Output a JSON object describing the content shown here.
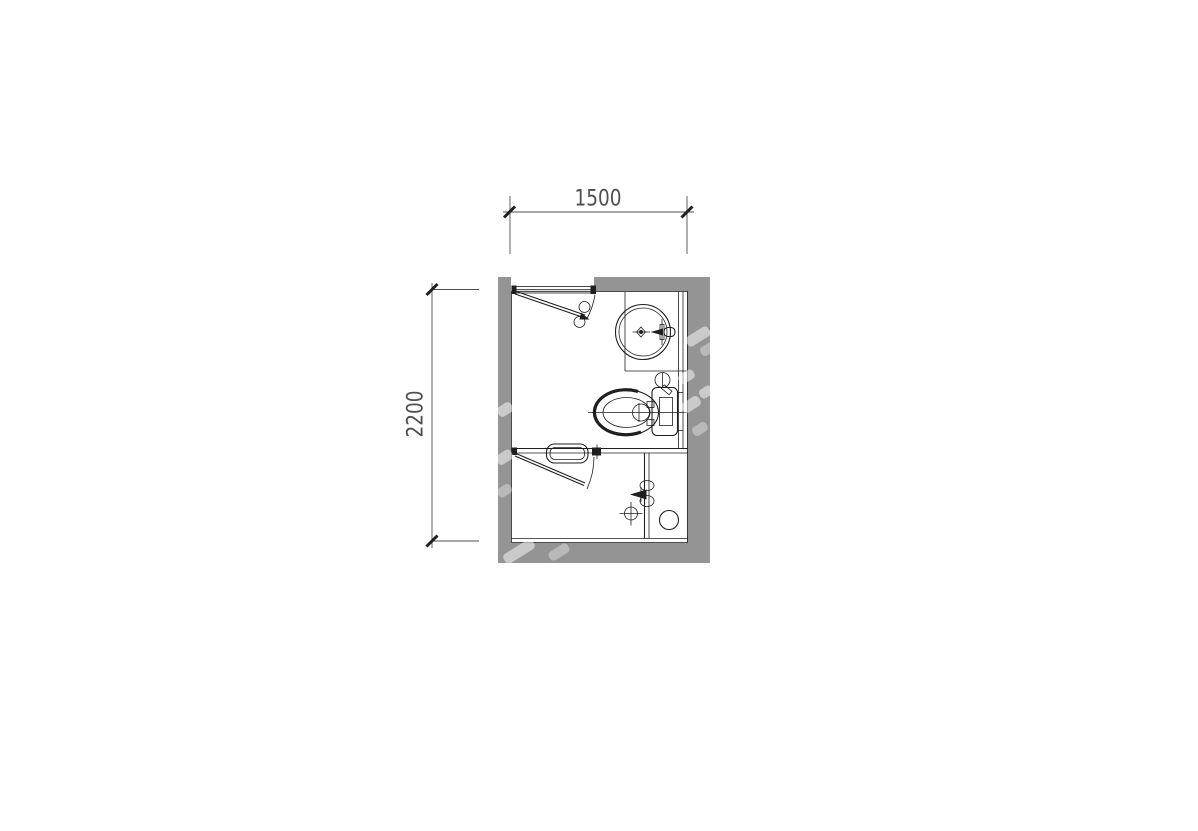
{
  "plan": {
    "description": "bathroom-floor-plan"
  },
  "colors": {
    "background": "#ffffff",
    "wall": "#949494",
    "line": "#1f1f1f",
    "dim": "#4f4f4f",
    "watermark": "#e2e2e2"
  },
  "dimensions": {
    "top": {
      "label": "1500"
    },
    "left": {
      "label": "2200"
    }
  },
  "icons": [
    "entry-door-swing-icon",
    "shower-door-swing-icon",
    "washbasin-icon",
    "faucet-icon",
    "toilet-icon",
    "cistern-icon",
    "supply-valve-icon",
    "towel-rail-icon",
    "shower-mixer-icon",
    "drain-cross-icon",
    "floor-drain-icon",
    "watermark"
  ]
}
